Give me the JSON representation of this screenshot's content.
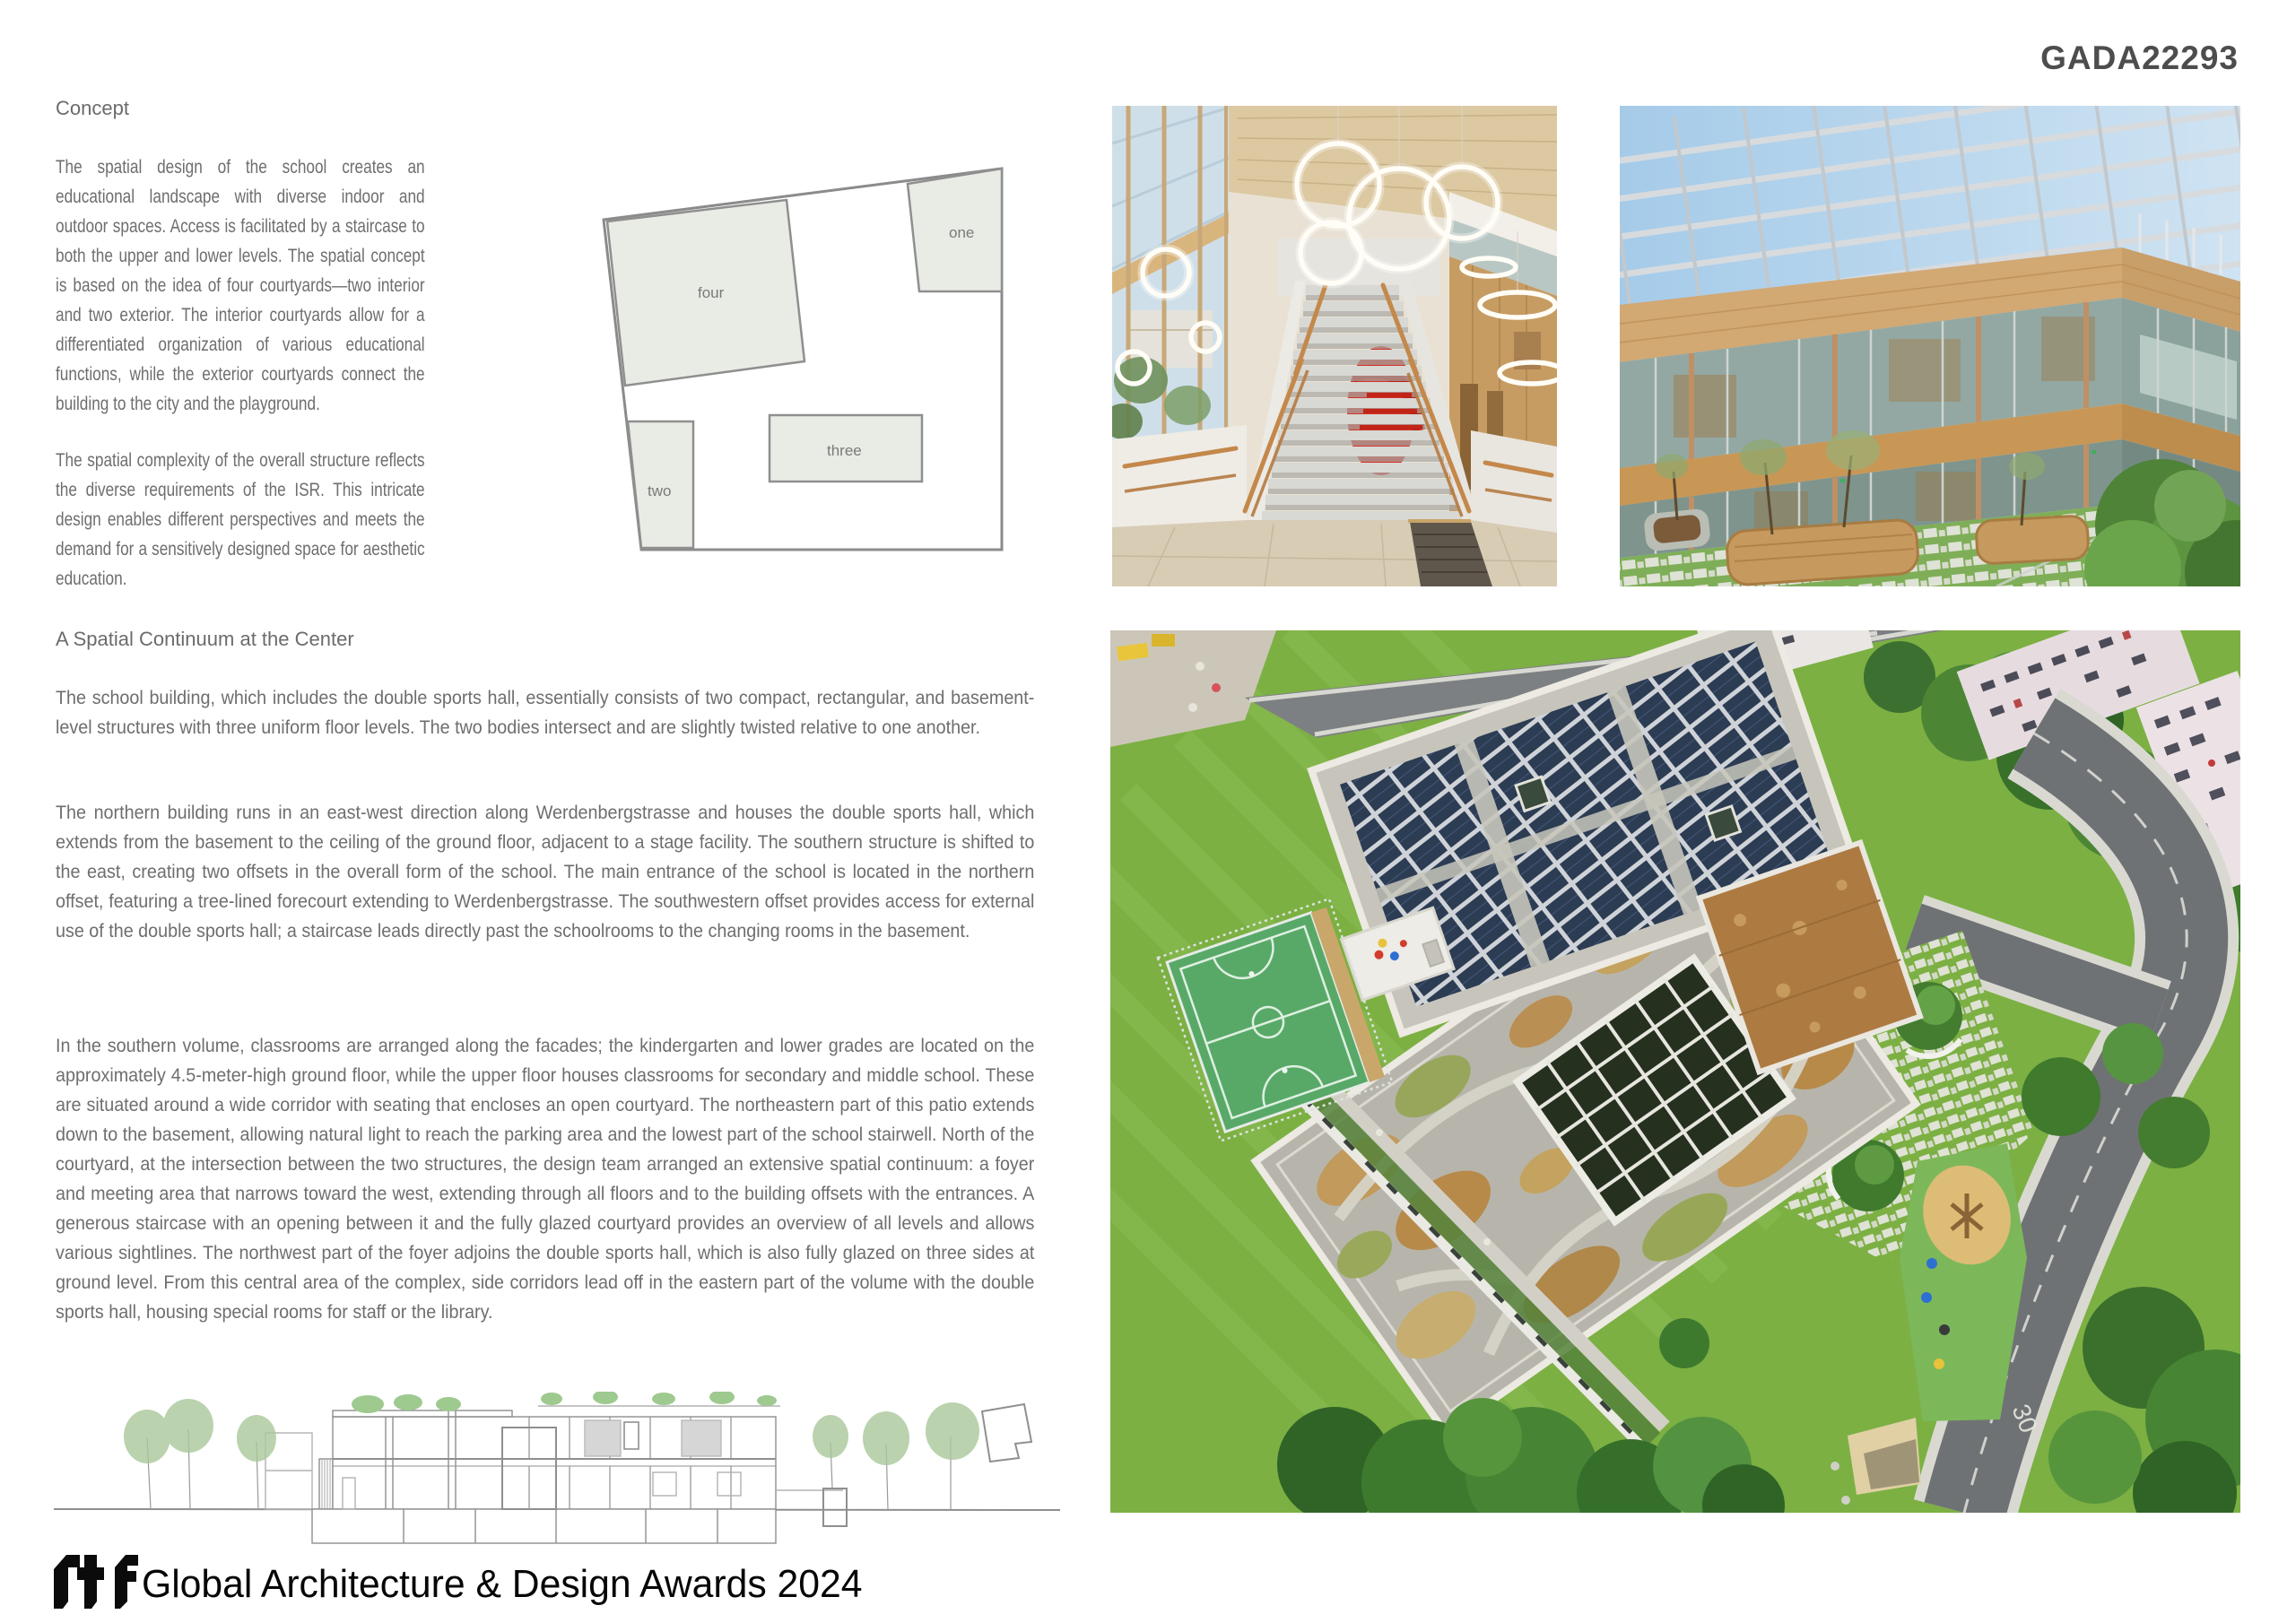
{
  "header": {
    "submission_code": "GADA22293"
  },
  "concept": {
    "heading": "Concept",
    "para1": "The spatial design of the school creates an educational landscape with diverse indoor and outdoor spaces. Access is facilitated by a staircase to both the upper and lower levels. The spatial concept is based on the idea of four courtyards—two interior and two exterior. The interior courtyards allow for a differentiated organization of various educational functions, while the exterior courtyards connect the building to the city and the playground.",
    "para2": "The spatial complexity of the overall structure reflects the diverse requirements of the ISR. This intricate design enables different perspectives and meets the demand for a sensitively designed space for aesthetic education."
  },
  "continuum": {
    "heading": "A Spatial Continuum at the Center",
    "para1": "The school building, which includes the double sports hall, essentially consists of two compact, rectangular, and basement-level structures with three uniform floor levels. The two bodies intersect and are slightly twisted relative to one another.",
    "para2": "The northern building runs in an east-west direction along Werdenbergstrasse and houses the double sports hall, which extends from the basement to the ceiling of the ground floor, adjacent to a stage facility. The southern structure is shifted to the east, creating two offsets in the overall form of the school. The main entrance of the school is located in the northern offset, featuring a tree-lined forecourt extending to Werdenbergstrasse. The southwestern offset provides access for external use of the double sports hall; a staircase leads directly past the schoolrooms to the changing rooms in the basement.",
    "para3": "In the southern volume, classrooms are arranged along the facades; the kindergarten and lower grades are located on the approximately 4.5-meter-high ground floor, while the upper floor houses classrooms for secondary and middle school. These are situated around a wide corridor with seating that encloses an open courtyard. The northeastern part of this patio extends down to the basement, allowing natural light to reach the parking area and the lowest part of the school stairwell. North of the courtyard, at the intersection between the two structures, the design team arranged an extensive spatial continuum: a foyer and meeting area that narrows toward the west, extending through all floors and to the building offsets with the entrances. A generous staircase with an opening between it and the fully glazed courtyard provides an overview of all levels and allows various sightlines. The northwest part of the foyer adjoins the double sports hall, which is also fully glazed on three sides at ground level. From this central area of the complex, side corridors lead off in the eastern part of the volume with the double sports hall, housing special rooms for staff or the library."
  },
  "courtyard_diagram": {
    "label_one": "one",
    "label_two": "two",
    "label_three": "three",
    "label_four": "four"
  },
  "aerial_markings": {
    "speed_limit_painted": "30"
  },
  "footer": {
    "logo_text": "rtf",
    "award_title": "Global Architecture & Design Awards 2024"
  },
  "colors": {
    "body_text": "#6e6e6e",
    "code_text": "#4d4d4d",
    "diagram_fill": "#e9ece4",
    "diagram_stroke": "#8f8f8f",
    "footer_text": "#060606",
    "solar_panel": "#2c3c53",
    "lawn_green": "#7cb043",
    "court_green": "#58a968"
  }
}
